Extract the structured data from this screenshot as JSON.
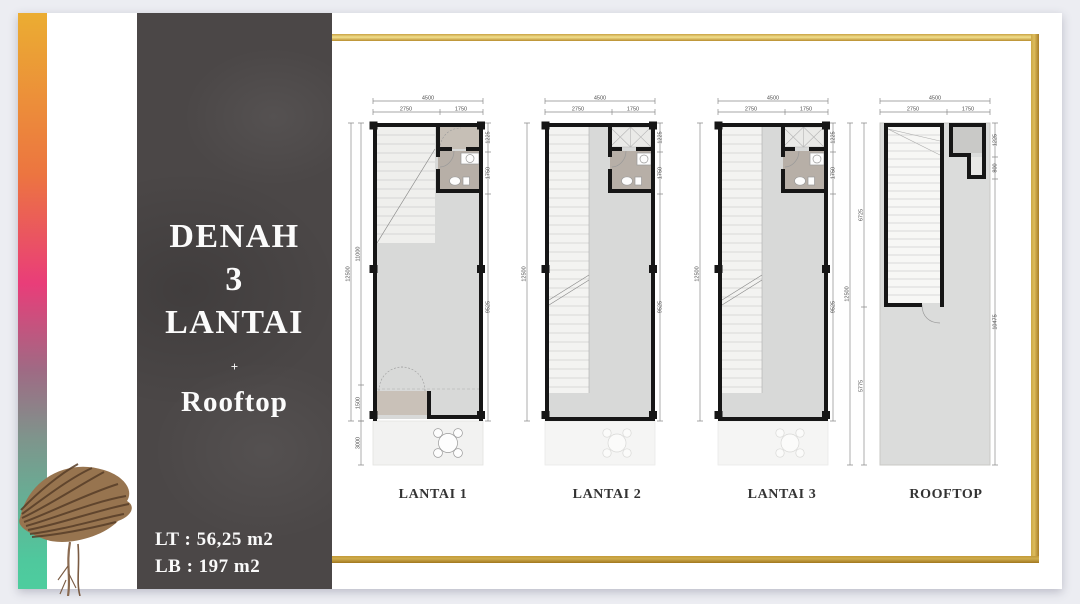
{
  "slide": {
    "panel": {
      "title_line1": "DENAH",
      "title_line2": "3",
      "title_line3": "LANTAI",
      "divider": "+",
      "subtitle": "Rooftop",
      "area_lt": "LT : 56,25 m2",
      "area_lb": "LB : 197 m2"
    },
    "colors": {
      "accent_gold": "#B9913B",
      "panel_bg": "#4B4747",
      "strip_top": "#EBAD32",
      "strip_mid": "#E93D79",
      "strip_bottom": "#4ECD9E",
      "floor_gray": "#D8D9D8",
      "bathroom_taupe": "#B7AFA7",
      "wall_black": "#161616"
    }
  },
  "plans": [
    {
      "label": "LANTAI 1",
      "dims": {
        "top_total": "4500",
        "top_left": "2750",
        "top_right": "1750",
        "left_total": "12500",
        "left_upper": "11000",
        "left_lower": "1500",
        "left_terrace": "3000",
        "right_top": "1225",
        "right_mid": "1750",
        "right_main": "9525"
      }
    },
    {
      "label": "LANTAI 2",
      "dims": {
        "top_total": "4500",
        "top_left": "2750",
        "top_right": "1750",
        "left_total": "12500",
        "right_top": "1225",
        "right_mid": "1750",
        "right_main": "9525"
      }
    },
    {
      "label": "LANTAI 3",
      "dims": {
        "top_total": "4500",
        "top_left": "2750",
        "top_right": "1750",
        "left_total": "12500",
        "right_top": "1225",
        "right_mid": "1750",
        "right_main": "9525"
      }
    },
    {
      "label": "ROOFTOP",
      "dims": {
        "top_total": "4500",
        "top_left": "2750",
        "top_right": "1750",
        "left_total": "12500",
        "left_stair": "6725",
        "left_lower": "5775",
        "right_top": "1225",
        "right_mid": "800",
        "right_main": "10475"
      }
    }
  ]
}
